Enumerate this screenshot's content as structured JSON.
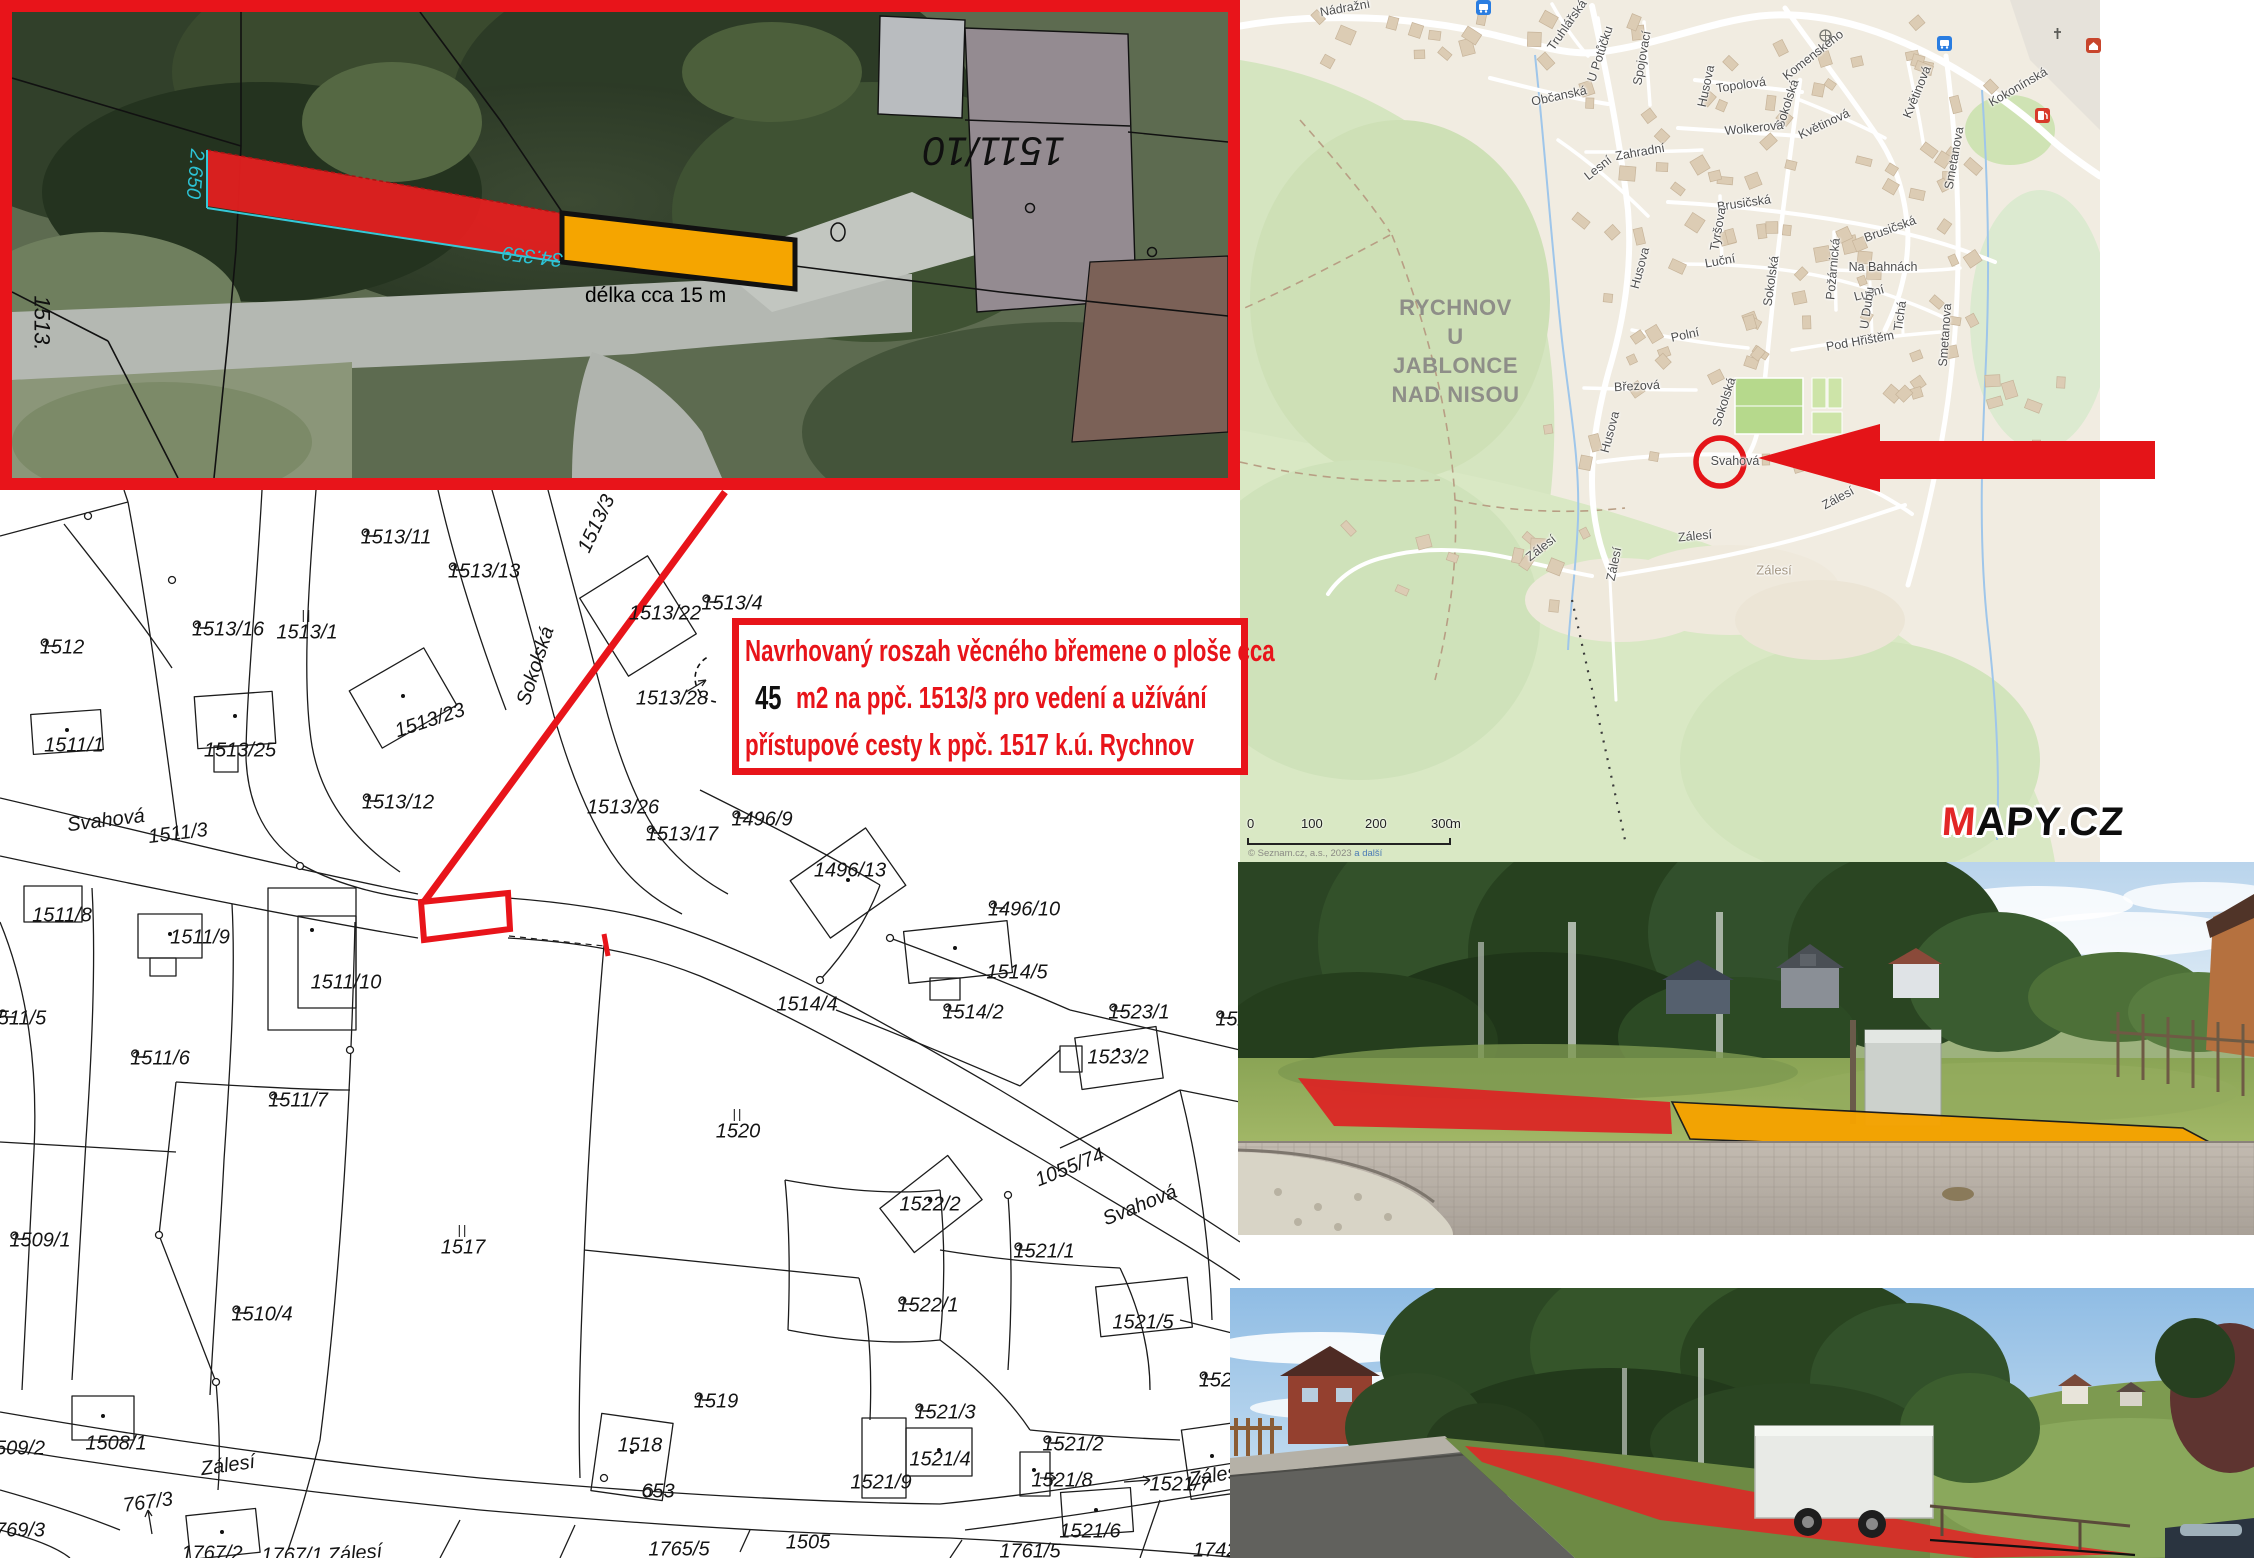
{
  "aerial": {
    "parcel_flipped": "1511/10",
    "edge_label": "1513.",
    "measure_main": "34.359",
    "measure_side": "2.650",
    "length_note": "délka cca 15 m"
  },
  "annotation": {
    "line1": "Navrhovaný roszah věcného břemene o ploše cca",
    "line2_value": "45",
    "line2_rest": " m2 na ppč. 1513/3 pro vedení a užívání",
    "line3": "přístupové cesty k ppč. 1517 k.ú. Rychnov"
  },
  "map": {
    "city_lines": [
      "RYCHNOV",
      "U JABLONCE",
      "NAD NISOU"
    ],
    "streets": [
      {
        "t": "Nádražní",
        "x": 105,
        "y": 8,
        "r": -10
      },
      {
        "t": "Truhlářská",
        "x": 327,
        "y": 25,
        "r": -55
      },
      {
        "t": "U Potůčku",
        "x": 360,
        "y": 54,
        "r": -72
      },
      {
        "t": "Spojovací",
        "x": 402,
        "y": 58,
        "r": -80
      },
      {
        "t": "Husova",
        "x": 466,
        "y": 86,
        "r": -78
      },
      {
        "t": "Topolová",
        "x": 501,
        "y": 85,
        "r": -8
      },
      {
        "t": "Sokolská",
        "x": 547,
        "y": 104,
        "r": -72
      },
      {
        "t": "Komenského",
        "x": 573,
        "y": 55,
        "r": -38
      },
      {
        "t": "Květinová",
        "x": 584,
        "y": 124,
        "r": -25
      },
      {
        "t": "Květinová",
        "x": 677,
        "y": 92,
        "r": -68
      },
      {
        "t": "Wolkerova",
        "x": 514,
        "y": 128,
        "r": -6
      },
      {
        "t": "Občanská",
        "x": 319,
        "y": 96,
        "r": -12
      },
      {
        "t": "Zahradní",
        "x": 400,
        "y": 152,
        "r": -10
      },
      {
        "t": "Lesní",
        "x": 358,
        "y": 168,
        "r": -38
      },
      {
        "t": "Brusičská",
        "x": 504,
        "y": 203,
        "r": -8
      },
      {
        "t": "Brusičská",
        "x": 650,
        "y": 229,
        "r": -20
      },
      {
        "t": "Tyršova",
        "x": 478,
        "y": 229,
        "r": -80
      },
      {
        "t": "Luční",
        "x": 480,
        "y": 261,
        "r": -10
      },
      {
        "t": "Luční",
        "x": 629,
        "y": 293,
        "r": -15
      },
      {
        "t": "Sokolská",
        "x": 531,
        "y": 281,
        "r": -82
      },
      {
        "t": "Požárnická",
        "x": 593,
        "y": 269,
        "r": -85
      },
      {
        "t": "Na Bahnách",
        "x": 643,
        "y": 267,
        "r": 0
      },
      {
        "t": "Smetanova",
        "x": 714,
        "y": 158,
        "r": -80
      },
      {
        "t": "Kokonínská",
        "x": 778,
        "y": 87,
        "r": -30
      },
      {
        "t": "Husova",
        "x": 400,
        "y": 268,
        "r": -75
      },
      {
        "t": "Polní",
        "x": 445,
        "y": 335,
        "r": -12
      },
      {
        "t": "Březová",
        "x": 397,
        "y": 386,
        "r": -3
      },
      {
        "t": "Husova",
        "x": 370,
        "y": 432,
        "r": -75
      },
      {
        "t": "Sokolská",
        "x": 484,
        "y": 402,
        "r": -72
      },
      {
        "t": "Pod Hřištěm",
        "x": 620,
        "y": 341,
        "r": -10
      },
      {
        "t": "U Dubu",
        "x": 627,
        "y": 308,
        "r": -82
      },
      {
        "t": "Tichá",
        "x": 660,
        "y": 316,
        "r": -82
      },
      {
        "t": "Smetanova",
        "x": 705,
        "y": 335,
        "r": -86
      },
      {
        "t": "Svahová",
        "x": 495,
        "y": 461,
        "r": 0
      },
      {
        "t": "Zálesí",
        "x": 598,
        "y": 498,
        "r": -28
      },
      {
        "t": "Zálesí",
        "x": 455,
        "y": 536,
        "r": -5
      },
      {
        "t": "Zálesí",
        "x": 301,
        "y": 548,
        "r": -38
      },
      {
        "t": "Zálesí",
        "x": 374,
        "y": 564,
        "r": -78
      },
      {
        "t": "Zálesí",
        "x": 534,
        "y": 570,
        "r": 0,
        "cls": "area"
      }
    ],
    "scale": {
      "ticks": [
        "0",
        "100",
        "200",
        "300"
      ],
      "unit": "m"
    },
    "attribution_main": "© Seznam.cz, a.s., 2023 ",
    "attribution_link": "a další",
    "logo_m": "M",
    "logo_rest": "APY.CZ"
  },
  "cadastre": {
    "labels": [
      {
        "t": "1512",
        "x": 62,
        "y": 158,
        "s": "c"
      },
      {
        "t": "1513/16",
        "x": 228,
        "y": 140,
        "s": "c"
      },
      {
        "t": "1513/1",
        "x": 307,
        "y": 136,
        "s": "l"
      },
      {
        "t": "1513/11",
        "x": 396,
        "y": 48,
        "s": "c"
      },
      {
        "t": "1513/13",
        "x": 484,
        "y": 82,
        "s": "c"
      },
      {
        "t": "Sokolská",
        "x": 536,
        "y": 176,
        "r": -72
      },
      {
        "t": "1513/3",
        "x": 597,
        "y": 34,
        "r": -65
      },
      {
        "t": "1513/22",
        "x": 665,
        "y": 124
      },
      {
        "t": "1513/4",
        "x": 732,
        "y": 114,
        "s": "c"
      },
      {
        "t": "1513/28",
        "x": 672,
        "y": 209
      },
      {
        "t": "1511/1",
        "x": 74,
        "y": 256
      },
      {
        "t": "1513/25",
        "x": 240,
        "y": 261
      },
      {
        "t": "1513/23",
        "x": 430,
        "y": 231,
        "r": -18
      },
      {
        "t": "1513/12",
        "x": 398,
        "y": 313,
        "s": "c"
      },
      {
        "t": "1513/26",
        "x": 623,
        "y": 318
      },
      {
        "t": "1513/17",
        "x": 682,
        "y": 345,
        "s": "c"
      },
      {
        "t": "1496/9",
        "x": 762,
        "y": 330,
        "s": "c"
      },
      {
        "t": "1496/13",
        "x": 850,
        "y": 381
      },
      {
        "t": "1514/4",
        "x": 807,
        "y": 515
      },
      {
        "t": "Svahová",
        "x": 106,
        "y": 331,
        "r": -7
      },
      {
        "t": "1511/3",
        "x": 178,
        "y": 344,
        "r": -7
      },
      {
        "t": "1511/8",
        "x": 62,
        "y": 426
      },
      {
        "t": "1511/9",
        "x": 200,
        "y": 448
      },
      {
        "t": "1511/10",
        "x": 346,
        "y": 493
      },
      {
        "t": "511/5",
        "x": 22,
        "y": 529,
        "s": "c"
      },
      {
        "t": "1511/6",
        "x": 160,
        "y": 569,
        "s": "c"
      },
      {
        "t": "1511/7",
        "x": 298,
        "y": 611,
        "s": "c"
      },
      {
        "t": "1496/10",
        "x": 1024,
        "y": 420,
        "s": "c"
      },
      {
        "t": "1514/5",
        "x": 1017,
        "y": 483
      },
      {
        "t": "1514/2",
        "x": 973,
        "y": 523,
        "s": "c"
      },
      {
        "t": "1523/1",
        "x": 1139,
        "y": 523,
        "s": "c"
      },
      {
        "t": "1523/2",
        "x": 1118,
        "y": 568
      },
      {
        "t": "152",
        "x": 1232,
        "y": 530,
        "s": "c"
      },
      {
        "t": "1509/1",
        "x": 40,
        "y": 751,
        "s": "c"
      },
      {
        "t": "1517",
        "x": 463,
        "y": 751,
        "s": "l"
      },
      {
        "t": "1510/4",
        "x": 262,
        "y": 825,
        "s": "c"
      },
      {
        "t": "1520",
        "x": 738,
        "y": 635,
        "s": "l"
      },
      {
        "t": "1522/2",
        "x": 930,
        "y": 715
      },
      {
        "t": "1055/74",
        "x": 1070,
        "y": 678,
        "r": -22
      },
      {
        "t": "Svahová",
        "x": 1140,
        "y": 716,
        "r": -22
      },
      {
        "t": "1521/1",
        "x": 1044,
        "y": 762,
        "s": "c"
      },
      {
        "t": "1522/1",
        "x": 928,
        "y": 816,
        "s": "c"
      },
      {
        "t": "1521/5",
        "x": 1143,
        "y": 833
      },
      {
        "t": "1519",
        "x": 716,
        "y": 912,
        "s": "c"
      },
      {
        "t": "1521/3",
        "x": 945,
        "y": 923,
        "s": "c"
      },
      {
        "t": "1521/2",
        "x": 1073,
        "y": 955,
        "s": "c"
      },
      {
        "t": "1521/9",
        "x": 881,
        "y": 993
      },
      {
        "t": "1521/6",
        "x": 1090,
        "y": 1042
      },
      {
        "t": "1524",
        "x": 1221,
        "y": 891,
        "s": "c"
      },
      {
        "t": "1508/1",
        "x": 116,
        "y": 954
      },
      {
        "t": "509/2",
        "x": 20,
        "y": 959
      },
      {
        "t": "1518",
        "x": 640,
        "y": 956
      },
      {
        "t": "653",
        "x": 658,
        "y": 1002
      },
      {
        "t": "1521/4",
        "x": 940,
        "y": 970
      },
      {
        "t": "1521/8",
        "x": 1062,
        "y": 991
      },
      {
        "t": "1521/7",
        "x": 1180,
        "y": 995
      },
      {
        "t": "Zálesí",
        "x": 1216,
        "y": 986,
        "r": -10
      },
      {
        "t": "1505",
        "x": 808,
        "y": 1053
      },
      {
        "t": "1765/5",
        "x": 679,
        "y": 1060
      },
      {
        "t": "1761/5",
        "x": 1030,
        "y": 1062
      },
      {
        "t": "1742/",
        "x": 1218,
        "y": 1061
      },
      {
        "t": "Zálesí",
        "x": 228,
        "y": 976,
        "r": -8
      },
      {
        "t": "767/3",
        "x": 148,
        "y": 1013,
        "r": -8
      },
      {
        "t": "769/3",
        "x": 20,
        "y": 1041
      },
      {
        "t": "1767/2",
        "x": 212,
        "y": 1064
      },
      {
        "t": "1767/1",
        "x": 292,
        "y": 1066
      },
      {
        "t": "Zálesí",
        "x": 355,
        "y": 1064,
        "r": -5
      }
    ]
  }
}
